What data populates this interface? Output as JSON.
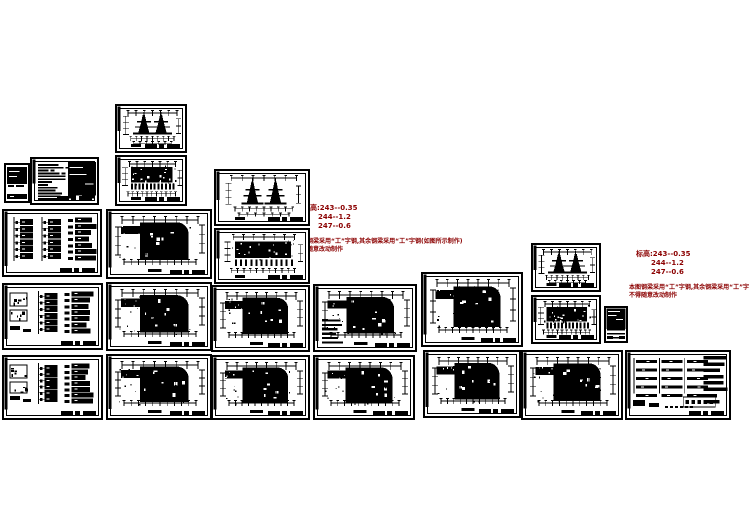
{
  "canvas": {
    "width": 749,
    "height": 530
  },
  "colors": {
    "paper": "#ffffff",
    "ink": "#000000",
    "annotation": "#8b0000"
  },
  "annotations": [
    {
      "id": "note-left",
      "lines": [
        "标高:243--0.35",
        "244--1.2",
        "247--0.6"
      ],
      "notes": [
        "本图钢梁采用“工”字钢,其余钢梁采用“工”字钢(如图所示制作)",
        "不得随意改动制作"
      ]
    },
    {
      "id": "note-right",
      "lines": [
        "标高:243--0.35",
        "244--1.2",
        "247--0.6"
      ],
      "notes": [
        "本图钢梁采用“工”字钢,其余钢梁采用“工”字钢(如图所示制作)",
        "不得随意改动制作"
      ]
    }
  ],
  "sheets": [
    {
      "id": "spec-table",
      "type": "small-table",
      "x": 4,
      "y": 163,
      "w": 26,
      "h": 40
    },
    {
      "id": "general-notes",
      "type": "notes",
      "x": 30,
      "y": 157,
      "w": 69,
      "h": 48
    },
    {
      "id": "system-diagram-1",
      "type": "system",
      "x": 2,
      "y": 209,
      "w": 100,
      "h": 68
    },
    {
      "id": "system-diagram-2",
      "type": "system2",
      "x": 2,
      "y": 283,
      "w": 101,
      "h": 67
    },
    {
      "id": "system-diagram-3",
      "type": "system2",
      "x": 2,
      "y": 355,
      "w": 101,
      "h": 65
    },
    {
      "id": "elev-upper-small",
      "type": "elev-towers",
      "x": 115,
      "y": 104,
      "w": 72,
      "h": 49
    },
    {
      "id": "elev-lower-small",
      "type": "elev-dense",
      "x": 115,
      "y": 155,
      "w": 72,
      "h": 51
    },
    {
      "id": "floor-plan-1",
      "type": "floorplan",
      "x": 106,
      "y": 209,
      "w": 106,
      "h": 70
    },
    {
      "id": "floor-plan-2",
      "type": "floorplan",
      "x": 106,
      "y": 282,
      "w": 106,
      "h": 69
    },
    {
      "id": "floor-plan-3",
      "type": "floorplan",
      "x": 106,
      "y": 354,
      "w": 106,
      "h": 66
    },
    {
      "id": "elev-upper-mid",
      "type": "elev-towers",
      "x": 214,
      "y": 169,
      "w": 96,
      "h": 57
    },
    {
      "id": "elev-lower-mid",
      "type": "elev-dense",
      "x": 214,
      "y": 228,
      "w": 96,
      "h": 56
    },
    {
      "id": "floor-plan-4",
      "type": "floorplan",
      "x": 211,
      "y": 285,
      "w": 99,
      "h": 67
    },
    {
      "id": "floor-plan-5",
      "type": "floorplan",
      "x": 211,
      "y": 355,
      "w": 99,
      "h": 65
    },
    {
      "id": "floor-plan-6",
      "type": "floorplan-legend",
      "x": 313,
      "y": 284,
      "w": 104,
      "h": 68
    },
    {
      "id": "floor-plan-7",
      "type": "floorplan",
      "x": 313,
      "y": 355,
      "w": 102,
      "h": 65
    },
    {
      "id": "floor-plan-8",
      "type": "floorplan",
      "x": 421,
      "y": 272,
      "w": 102,
      "h": 75
    },
    {
      "id": "floor-plan-9",
      "type": "floorplan",
      "x": 423,
      "y": 350,
      "w": 98,
      "h": 68
    },
    {
      "id": "elev-upper-right",
      "type": "elev-towers",
      "x": 531,
      "y": 243,
      "w": 70,
      "h": 49
    },
    {
      "id": "elev-lower-right",
      "type": "elev-dense",
      "x": 531,
      "y": 295,
      "w": 70,
      "h": 49
    },
    {
      "id": "title-block-sheet",
      "type": "title-dark",
      "x": 604,
      "y": 306,
      "w": 24,
      "h": 37
    },
    {
      "id": "floor-plan-10",
      "type": "floorplan",
      "x": 521,
      "y": 350,
      "w": 102,
      "h": 70
    },
    {
      "id": "system-diagram-4",
      "type": "system-wide",
      "x": 625,
      "y": 350,
      "w": 106,
      "h": 70
    }
  ]
}
